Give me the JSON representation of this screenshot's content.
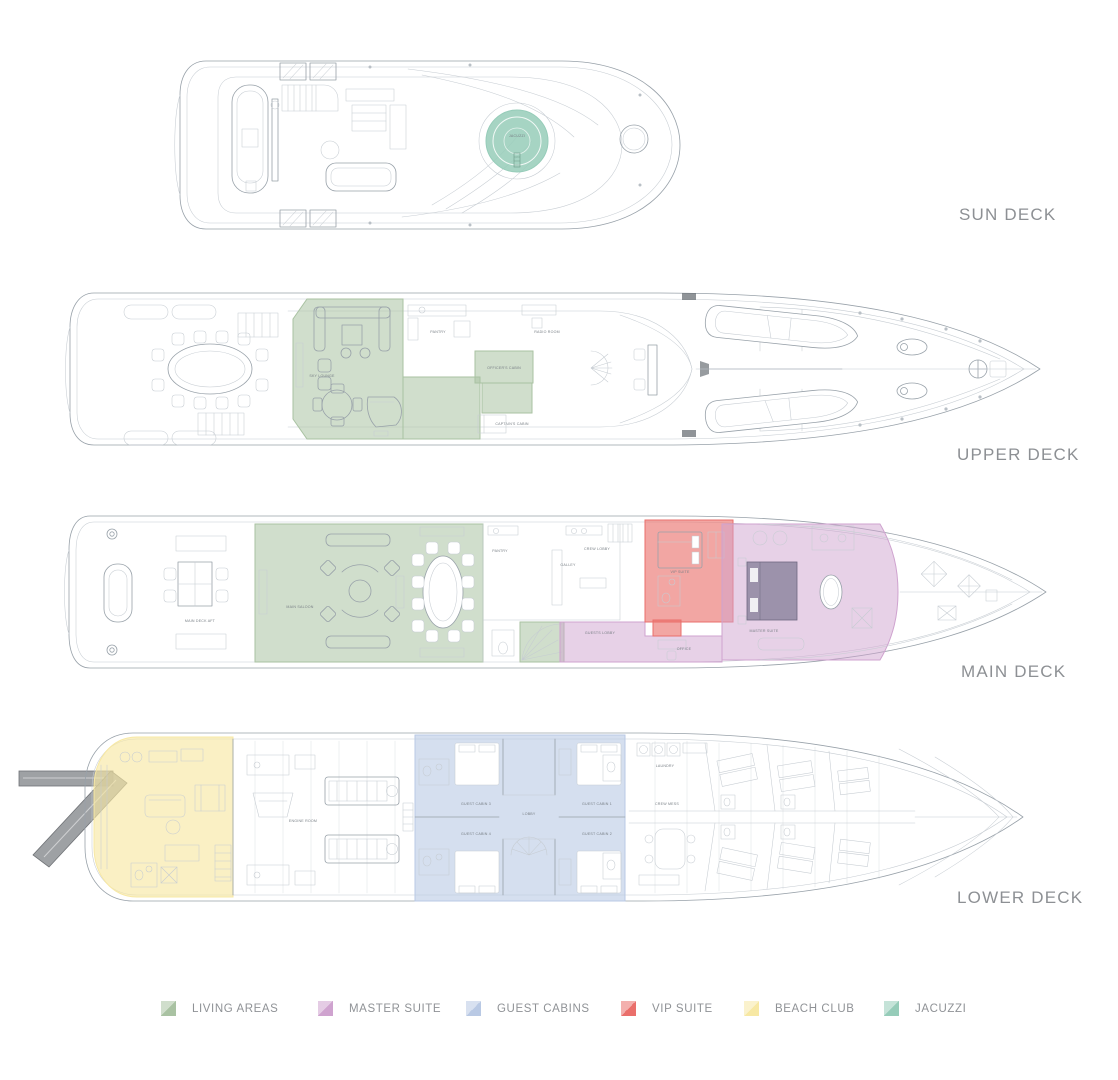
{
  "decks": [
    {
      "id": "sun",
      "label": "SUN DECK"
    },
    {
      "id": "upper",
      "label": "UPPER DECK"
    },
    {
      "id": "main",
      "label": "MAIN DECK"
    },
    {
      "id": "lower",
      "label": "LOWER DECK"
    }
  ],
  "legend": [
    {
      "id": "living",
      "label": "LIVING AREAS",
      "color": "#a9c2a2"
    },
    {
      "id": "master",
      "label": "MASTER SUITE",
      "color": "#cfa3cf"
    },
    {
      "id": "guest",
      "label": "GUEST CABINS",
      "color": "#b9c9e4"
    },
    {
      "id": "vip",
      "label": "VIP SUITE",
      "color": "#ea6f6b"
    },
    {
      "id": "beach",
      "label": "BEACH CLUB",
      "color": "#f7e8a4"
    },
    {
      "id": "jacuzzi",
      "label": "JACUZZI",
      "color": "#96ccb9"
    }
  ],
  "labels": {
    "jacuzzi": "JACUZZI",
    "sky_lounge": "SKY LOUNGE",
    "pantry_upper": "PANTRY",
    "radio_room": "RADIO ROOM",
    "officers_cabin": "OFFICER'S CABIN",
    "captains_cabin": "CAPTAIN'S CABIN",
    "main_deck_aft": "MAIN DECK AFT",
    "main_saloon": "MAIN SALOON",
    "pantry_main": "PANTRY",
    "galley": "GALLEY",
    "crew_lobby": "CREW LOBBY",
    "guests_lobby": "GUESTS LOBBY",
    "office": "OFFICE",
    "vip_suite": "VIP SUITE",
    "master_suite": "MASTER SUITE",
    "engine_room": "ENGINE ROOM",
    "lobby": "LOBBY",
    "guest_cabin_1": "GUEST CABIN 1",
    "guest_cabin_2": "GUEST CABIN 2",
    "guest_cabin_3": "GUEST CABIN 3",
    "guest_cabin_4": "GUEST CABIN 4",
    "crew_mess": "CREW MESS",
    "laundry": "LAUNDRY"
  },
  "colors": {
    "living": "#a9c2a2",
    "master": "#cfa3cf",
    "guest": "#b9c9e4",
    "vip": "#ea6f6b",
    "beach": "#f7e8a4",
    "jacuzzi": "#96ccb9",
    "line": "#98a1a9",
    "lineLight": "#c6ccd2",
    "deckLabel": "#8d9094",
    "roomLabel": "#787f85",
    "gangway": "#8d9094"
  }
}
